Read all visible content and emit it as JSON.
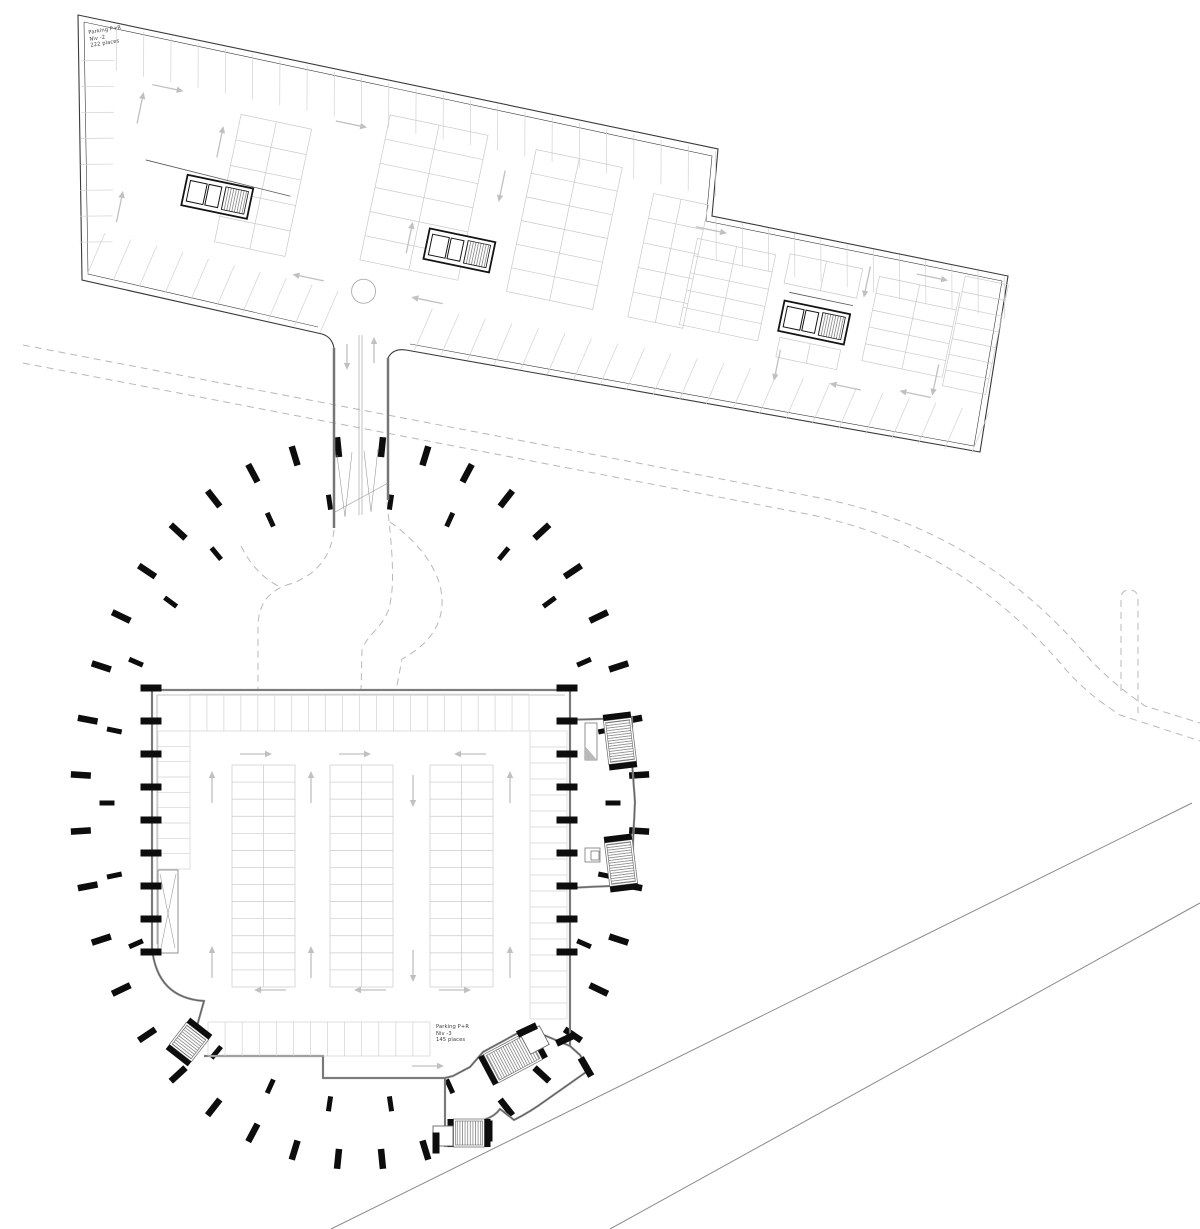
{
  "title": "Parking P+R underground levels site plan",
  "colors": {
    "wall_dark": "#3a3a3a",
    "wall_gray": "#8f8f8f",
    "wall_thin": "#474747",
    "stall": "#d2d2d2",
    "island": "#c9c9c9",
    "arrow": "#c0c0c0",
    "black": "#0d0d0d",
    "road_dash": "#b8b8b8",
    "road_solid": "#8a8a8a",
    "core_edge": "#141414",
    "text": "#3c3c3c",
    "stair_frame": "#767676"
  },
  "labels": {
    "upper": {
      "line1": "Parking P+R",
      "line2": "Niv -2",
      "line3": "222 places",
      "x": 88,
      "y": 30,
      "rot": -9
    },
    "lower": {
      "line1": "Parking P+R",
      "line2": "Niv -3",
      "line3": "145 places",
      "x": 436,
      "y": 1024,
      "rot": 0
    }
  },
  "roads": {
    "dashed": [
      "M 23,345 L 820,498 C 930,520 1015,572 1088,657 Q 1108,680 1145,706 L 1200,723",
      "M 23,363 L 812,515 C 915,537 995,588 1062,665 Q 1084,692 1120,715 L 1200,741",
      "M 1121,691 L 1121,599 Q 1121,590 1129,590 Q 1138,590 1138,599 L 1138,713",
      "M 334,530 C 331,560 312,577 290,584 C 270,590 259,602 258,625 L 258,691",
      "M 241,546 C 251,566 264,579 280,587",
      "M 387,502 C 392,548 396,588 388,611 C 381,629 366,636 362,650 L 361,691",
      "M 390,522 C 428,549 447,583 441,613 C 436,637 418,650 402,659 L 396,691"
    ],
    "solid": [
      "M 331,1229 L 1192,803",
      "M 610,1229 L 1200,903"
    ]
  },
  "rings": {
    "cx": 360,
    "cy": 803,
    "list": [
      {
        "rx": 280,
        "ry": 357,
        "count": 40,
        "offset": 4.5,
        "len": 20,
        "w": 6.5
      },
      {
        "rx": 253,
        "ry": 303,
        "count": 26,
        "offset": 0,
        "len": 15,
        "w": 5
      }
    ],
    "skip": [
      158,
      696,
      564,
      1052
    ]
  },
  "ramp": {
    "walls": [
      "M 334,348 L 334,528",
      "M 388,358 L 388,500"
    ],
    "thin": [
      "M 359,335 L 359,515",
      "M 362,335 L 362,515",
      "M 335,512 L 388,483",
      "M 337,455 L 345,517 L 352,452",
      "M 364,451 L 371,512 L 378,449"
    ],
    "arrows": [
      {
        "x": 347,
        "y": 357,
        "dir": "down",
        "len": 26
      },
      {
        "x": 374,
        "y": 350,
        "dir": "up",
        "len": 26
      }
    ]
  },
  "upper_building": {
    "origin": [
      78,
      15
    ],
    "rotation": 11.8,
    "outline_outer": "M 388,358 Q 393,348 406,350 L 980,452 L 1008,276 L 712,216 L 718,149 L 78,15 L 82,280 L 322,334 Q 332,337 334,348",
    "outline_inner": "M 84,22 L 712,156 L 706,221 L 1002,281 L 974,446 L 410,344 M 318,327 L 88,274 L 84,22",
    "bands": [
      {
        "s": [
          40,
          3
        ],
        "e": [
          652,
          3
        ],
        "d": [
          9,
          44
        ],
        "n": 22
      },
      {
        "s": [
          666,
          68
        ],
        "e": [
          960,
          66
        ],
        "d": [
          9,
          42
        ],
        "n": 11
      },
      {
        "s": [
          62,
          252
        ],
        "e": [
          302,
          261
        ],
        "d": [
          9,
          -44
        ],
        "n": 9
      },
      {
        "s": [
          398,
          259
        ],
        "e": [
          964,
          247
        ],
        "d": [
          9,
          -44
        ],
        "n": 21
      },
      {
        "s": [
          13,
          44
        ],
        "e": [
          48,
          222
        ],
        "d": [
          32,
          -7
        ],
        "n": 7
      }
    ],
    "islands": [
      {
        "x": 180,
        "y": 64,
        "w": 72,
        "h": 130,
        "rows": 5,
        "cols": 2
      },
      {
        "x": 326,
        "y": 34,
        "w": 100,
        "h": 148,
        "rows": 6,
        "cols": 2
      },
      {
        "x": 476,
        "y": 38,
        "w": 88,
        "h": 145,
        "rows": 6,
        "cols": 2
      },
      {
        "x": 600,
        "y": 57,
        "w": 56,
        "h": 126,
        "rows": 5,
        "cols": 2
      },
      {
        "x": 652,
        "y": 92,
        "w": 80,
        "h": 88,
        "rows": 5,
        "cols": 2
      },
      {
        "x": 746,
        "y": 88,
        "w": 74,
        "h": 30,
        "rows": 1,
        "cols": 2
      },
      {
        "x": 753,
        "y": 172,
        "w": 62,
        "h": 20,
        "rows": 1,
        "cols": 2
      },
      {
        "x": 838,
        "y": 92,
        "w": 82,
        "h": 86,
        "rows": 5,
        "cols": 2
      },
      {
        "x": 922,
        "y": 74,
        "w": 44,
        "h": 112,
        "rows": 7,
        "cols": 1
      }
    ],
    "cores": [
      [
        140,
        134
      ],
      [
        388,
        137
      ],
      [
        750,
        135
      ]
    ],
    "extra_lines": [
      [
        96,
        128,
        245,
        134
      ],
      [
        753,
        126,
        818,
        126
      ]
    ],
    "circle": [
      336,
      212,
      12
    ],
    "arrows": [
      {
        "x": 103,
        "y": 53,
        "dir": "right"
      },
      {
        "x": 290,
        "y": 51,
        "dir": "right"
      },
      {
        "x": 664,
        "y": 81,
        "dir": "right"
      },
      {
        "x": 890,
        "y": 82,
        "dir": "right"
      },
      {
        "x": 80,
        "y": 78,
        "dir": "up"
      },
      {
        "x": 165,
        "y": 95,
        "dir": "up"
      },
      {
        "x": 80,
        "y": 179,
        "dir": "up"
      },
      {
        "x": 370,
        "y": 150,
        "dir": "up"
      },
      {
        "x": 450,
        "y": 81,
        "dir": "down"
      },
      {
        "x": 756,
        "y": 200,
        "dir": "down"
      },
      {
        "x": 827,
        "y": 100,
        "dir": "down"
      },
      {
        "x": 914,
        "y": 182,
        "dir": "down"
      },
      {
        "x": 279,
        "y": 210,
        "dir": "left"
      },
      {
        "x": 400,
        "y": 208,
        "dir": "left"
      },
      {
        "x": 827,
        "y": 207,
        "dir": "left"
      },
      {
        "x": 897,
        "y": 200,
        "dir": "left"
      }
    ]
  },
  "lower_building": {
    "walls": [
      "M 152,948 L 152,690 L 570,690 L 570,1046",
      "M 152,948 Q 157,998 204,1001 L 197,1026",
      "M 204,1056 L 323,1056 L 323,1078 L 445,1078 L 445,1120",
      "M 563,720 L 632,718 L 632,762 L 635,802 L 633,842 L 633,885 L 566,888",
      "M 445,1078 L 453,1076 L 470,1067 L 483,1052 L 527,1028 L 570,1046",
      "M 570,1046 L 580,1055 L 589,1070 L 545,1101 Q 530,1112 514,1120 L 500,1109 Q 495,1116 486,1119 L 486,1146 L 445,1146 L 445,1120"
    ],
    "inner_line": "M 157,944 L 157,695 L 565,695",
    "bands": [
      {
        "x": 190,
        "y": 694,
        "w": 339,
        "h": 37,
        "dividers": 19,
        "dir": "v"
      },
      {
        "x": 158,
        "y": 731,
        "w": 32,
        "h": 138,
        "dividers": 8,
        "dir": "h"
      },
      {
        "x": 530,
        "y": 731,
        "w": 37,
        "h": 288,
        "dividers": 17,
        "dir": "h"
      },
      {
        "x": 208,
        "y": 1022,
        "w": 222,
        "h": 34,
        "dividers": 12,
        "dir": "v"
      }
    ],
    "islands": [
      {
        "x": 232,
        "y": 765,
        "w": 63,
        "h": 222,
        "rows": 13
      },
      {
        "x": 330,
        "y": 765,
        "w": 63,
        "h": 222,
        "rows": 13
      },
      {
        "x": 430,
        "y": 765,
        "w": 63,
        "h": 222,
        "rows": 13
      }
    ],
    "vestibules": [
      {
        "type": "rect",
        "x": 158,
        "y": 870,
        "w": 20,
        "h": 83
      },
      {
        "type": "line",
        "d": "M 160,874 L 175,948"
      },
      {
        "type": "line",
        "d": "M 176,874 L 161,948"
      },
      {
        "type": "rect",
        "x": 585,
        "y": 723,
        "w": 12,
        "h": 37
      },
      {
        "type": "tri",
        "d": "M 585,746 L 597,760 L 585,760 Z"
      },
      {
        "type": "rect",
        "x": 585,
        "y": 848,
        "w": 15,
        "h": 14
      },
      {
        "type": "rect",
        "x": 591,
        "y": 851,
        "w": 8,
        "h": 9
      }
    ],
    "stairs": [
      {
        "cx": 620,
        "cy": 741,
        "w": 24,
        "h": 40,
        "rot": -7,
        "treads": "h",
        "bars": "v"
      },
      {
        "cx": 621,
        "cy": 863,
        "w": 24,
        "h": 40,
        "rot": -7,
        "treads": "h",
        "bars": "v"
      },
      {
        "cx": 513,
        "cy": 1057,
        "w": 46,
        "h": 28,
        "rot": -28,
        "treads": "v",
        "bars": "h"
      },
      {
        "cx": 469,
        "cy": 1133,
        "w": 27,
        "h": 24,
        "rot": 0,
        "treads": "v",
        "bars": "h"
      },
      {
        "cx": 189,
        "cy": 1042,
        "w": 24,
        "h": 24,
        "rot": 38,
        "treads": "h",
        "bars": "v"
      }
    ],
    "squares": [
      {
        "cx": 535,
        "cy": 1040,
        "s": 21,
        "rot": -28
      },
      {
        "cx": 443,
        "cy": 1136,
        "s": 20,
        "rot": 0
      }
    ],
    "ticks": [
      [
        527,
        1030,
        -25
      ],
      [
        566,
        1039,
        -25
      ],
      [
        586,
        1067,
        60
      ],
      [
        436,
        1143,
        90
      ],
      [
        489,
        1131,
        90
      ]
    ],
    "wall_ticks": {
      "size": [
        21,
        7
      ],
      "cols": [
        {
          "x": 151,
          "y0": 688,
          "n": 9,
          "dy": 33
        },
        {
          "x": 567,
          "y0": 688,
          "n": 9,
          "dy": 33
        }
      ]
    },
    "arrows": [
      {
        "x": 256,
        "y": 754,
        "dir": "right"
      },
      {
        "x": 355,
        "y": 754,
        "dir": "right"
      },
      {
        "x": 470,
        "y": 754,
        "dir": "left"
      },
      {
        "x": 212,
        "y": 787,
        "dir": "up"
      },
      {
        "x": 311,
        "y": 787,
        "dir": "up"
      },
      {
        "x": 413,
        "y": 791,
        "dir": "down"
      },
      {
        "x": 510,
        "y": 787,
        "dir": "up"
      },
      {
        "x": 212,
        "y": 962,
        "dir": "up"
      },
      {
        "x": 311,
        "y": 962,
        "dir": "up"
      },
      {
        "x": 413,
        "y": 966,
        "dir": "down"
      },
      {
        "x": 510,
        "y": 962,
        "dir": "up"
      },
      {
        "x": 270,
        "y": 990,
        "dir": "left"
      },
      {
        "x": 370,
        "y": 990,
        "dir": "left"
      },
      {
        "x": 455,
        "y": 990,
        "dir": "right"
      },
      {
        "x": 428,
        "y": 1066,
        "dir": "right"
      }
    ]
  }
}
